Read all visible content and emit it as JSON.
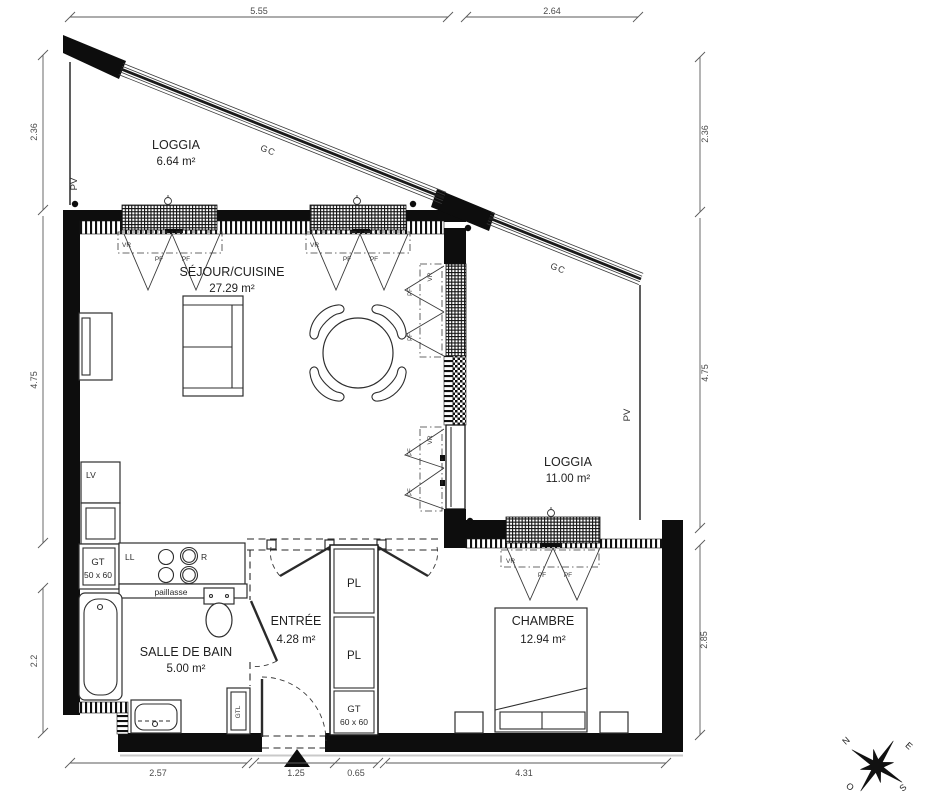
{
  "rooms": {
    "loggia_left": {
      "name": "LOGGIA",
      "area": "6.64 m²"
    },
    "sejour": {
      "name": "SÉJOUR/CUISINE",
      "area": "27.29 m²"
    },
    "loggia_right": {
      "name": "LOGGIA",
      "area": "11.00 m²"
    },
    "salle_de_bain": {
      "name": "SALLE DE BAIN",
      "area": "5.00 m²"
    },
    "entree": {
      "name": "ENTRÉE",
      "area": "4.28 m²"
    },
    "chambre": {
      "name": "CHAMBRE",
      "area": "12.94 m²"
    }
  },
  "dimensions": {
    "top": [
      "5.55",
      "2.64"
    ],
    "left": [
      "2.36",
      "4.75",
      "2.2"
    ],
    "right": [
      "2.36",
      "4.75",
      "2.85"
    ],
    "bottom": [
      "2.57",
      "1.25",
      "0.65",
      "4.31"
    ]
  },
  "annotations": {
    "gc": "GC",
    "pv": "PV",
    "vr": "VR",
    "pf": "PF",
    "pl": "PL",
    "lv": "LV",
    "ll": "LL",
    "r": "R",
    "gtl": "GTL",
    "gt_bath": "GT",
    "gt_bath_size": "50 x 60",
    "gt_entry": "GT",
    "gt_entry_size": "60 x 60",
    "paillasse": "paillasse"
  },
  "compass": {
    "north": "N",
    "east": "E",
    "south": "S",
    "west": "O"
  }
}
